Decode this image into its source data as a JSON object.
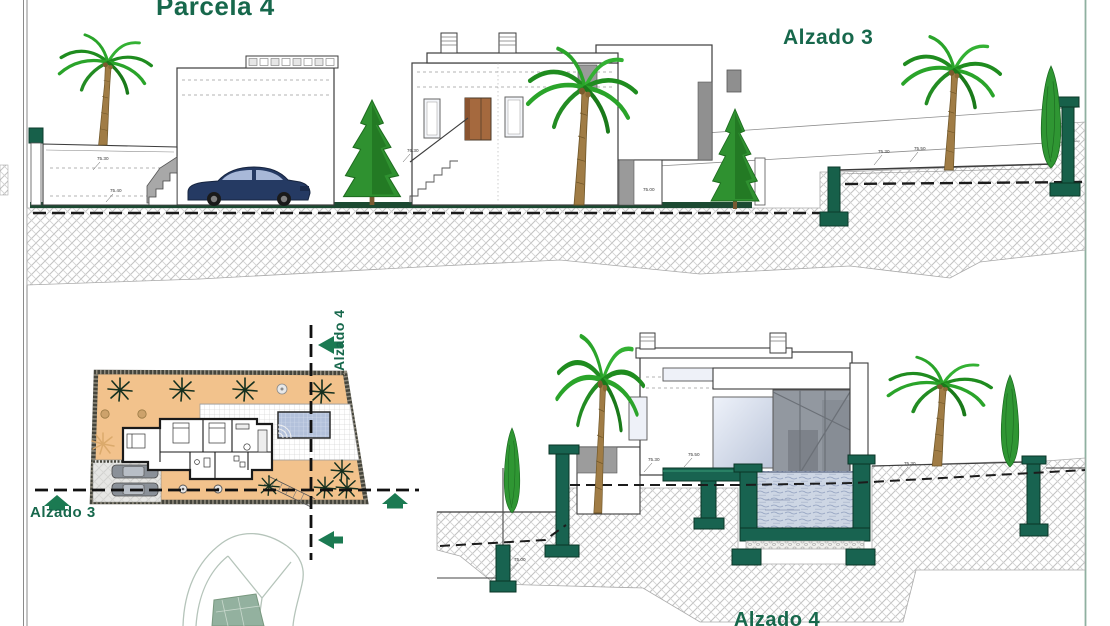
{
  "titles": {
    "parcela": "Parcela 4",
    "alzado3_elevation": "Alzado 3",
    "alzado3_section_label": "Alzado 3",
    "alzado4_section_label": "Alzado 4",
    "alzado4_elevation": "Alzado 4"
  },
  "dimension_labels": {
    "d1": "75.30",
    "d2": "75.40",
    "d3": "76.30",
    "d4": "75.00",
    "d5": "75.30",
    "d6": "75.50",
    "d7": "75.00",
    "d8": "75.30",
    "d9": "75.50",
    "d10": "75.30"
  },
  "colors": {
    "title_green": "#17684c",
    "structure_green": "#186350",
    "ground_bar_green": "#1c4a32",
    "arrow_green": "#1b7a52",
    "plan_plot_orange": "#f2c28c",
    "pool_plan_blue": "#b3c1db",
    "water_section": "#cdd6e4",
    "car_navy": "#253a63",
    "hatch_gray": "#c2c2c2",
    "building_outline": "#3d3d3d"
  }
}
